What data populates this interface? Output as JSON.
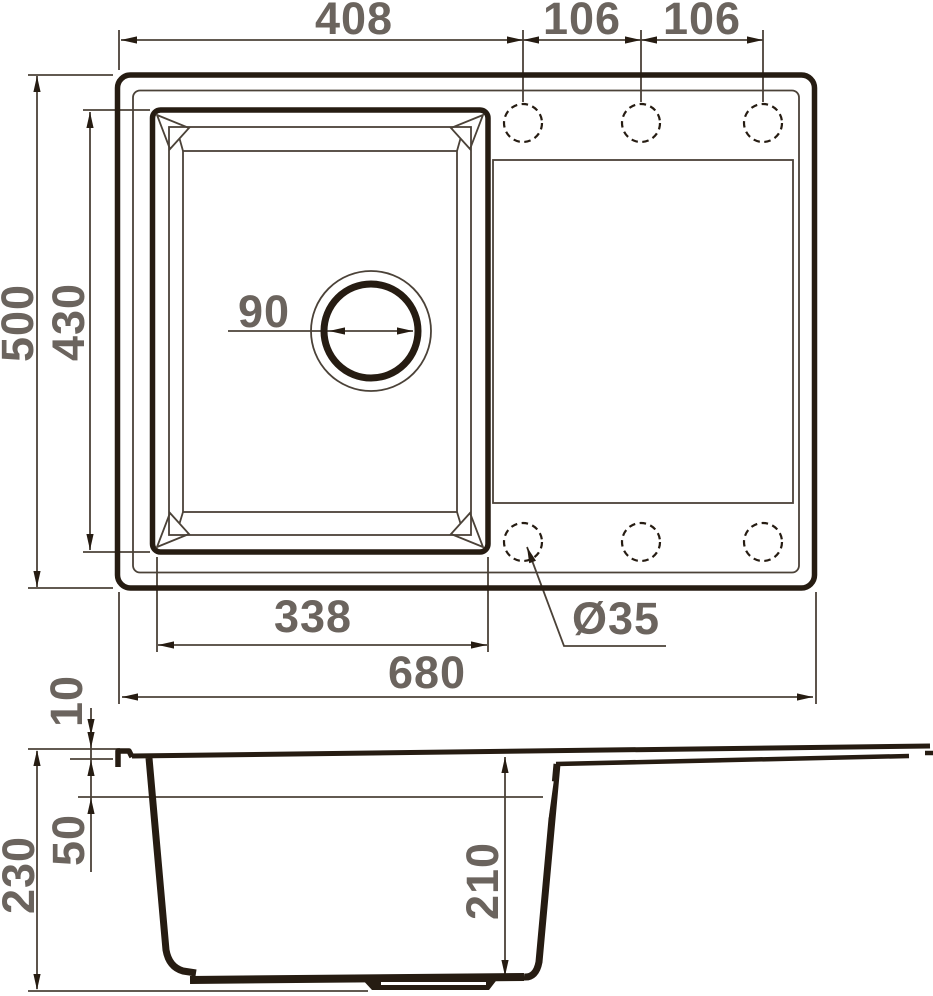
{
  "drawing": {
    "type": "technical-dimension-drawing",
    "subject": "kitchen sink with single bowl and drainboard, top view and section view",
    "colors": {
      "ink": "#261c12",
      "line": "#4b4238",
      "label": "#6b645e",
      "background": "#ffffff"
    },
    "top_view": {
      "width_to_first_hole": "408",
      "hole_spacing_left": "106",
      "hole_spacing_right": "106",
      "overall_depth": "500",
      "bowl_outer_depth": "430",
      "drain_diameter": "90",
      "bowl_outer_width": "338",
      "overall_width": "680",
      "faucet_hole_diameter": "Ø35"
    },
    "section_view": {
      "rim_lip_height": "10",
      "rim_band_height": "50",
      "overall_height": "230",
      "bowl_inner_depth": "210"
    }
  }
}
